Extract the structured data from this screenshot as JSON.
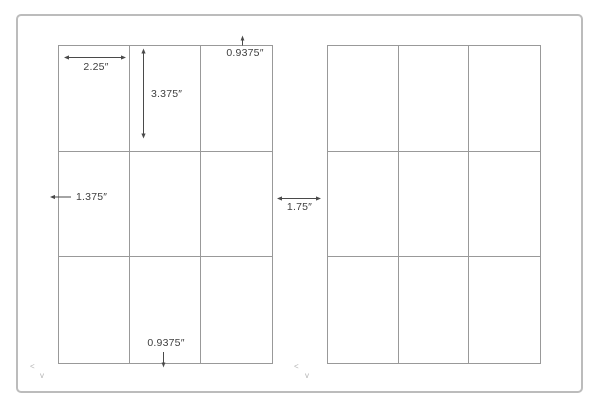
{
  "diagram": {
    "sheets": {
      "count": 2,
      "rows": 3,
      "columns": 3
    },
    "dimensions": {
      "label_width": "2.25″",
      "label_height": "3.375″",
      "top_margin": "0.9375″",
      "left_margin": "1.375″",
      "sheet_gap": "1.75″",
      "bottom_margin": "0.9375″"
    },
    "marks": {
      "left_chevron": "<",
      "down_chevron": "v"
    },
    "colors": {
      "background": "#ffffff",
      "page_outline": "#bcbcbc",
      "grid_line": "#999999",
      "dimension_line": "#4a4a4a",
      "dimension_text": "#404040",
      "mark": "#b3b3b3"
    }
  }
}
